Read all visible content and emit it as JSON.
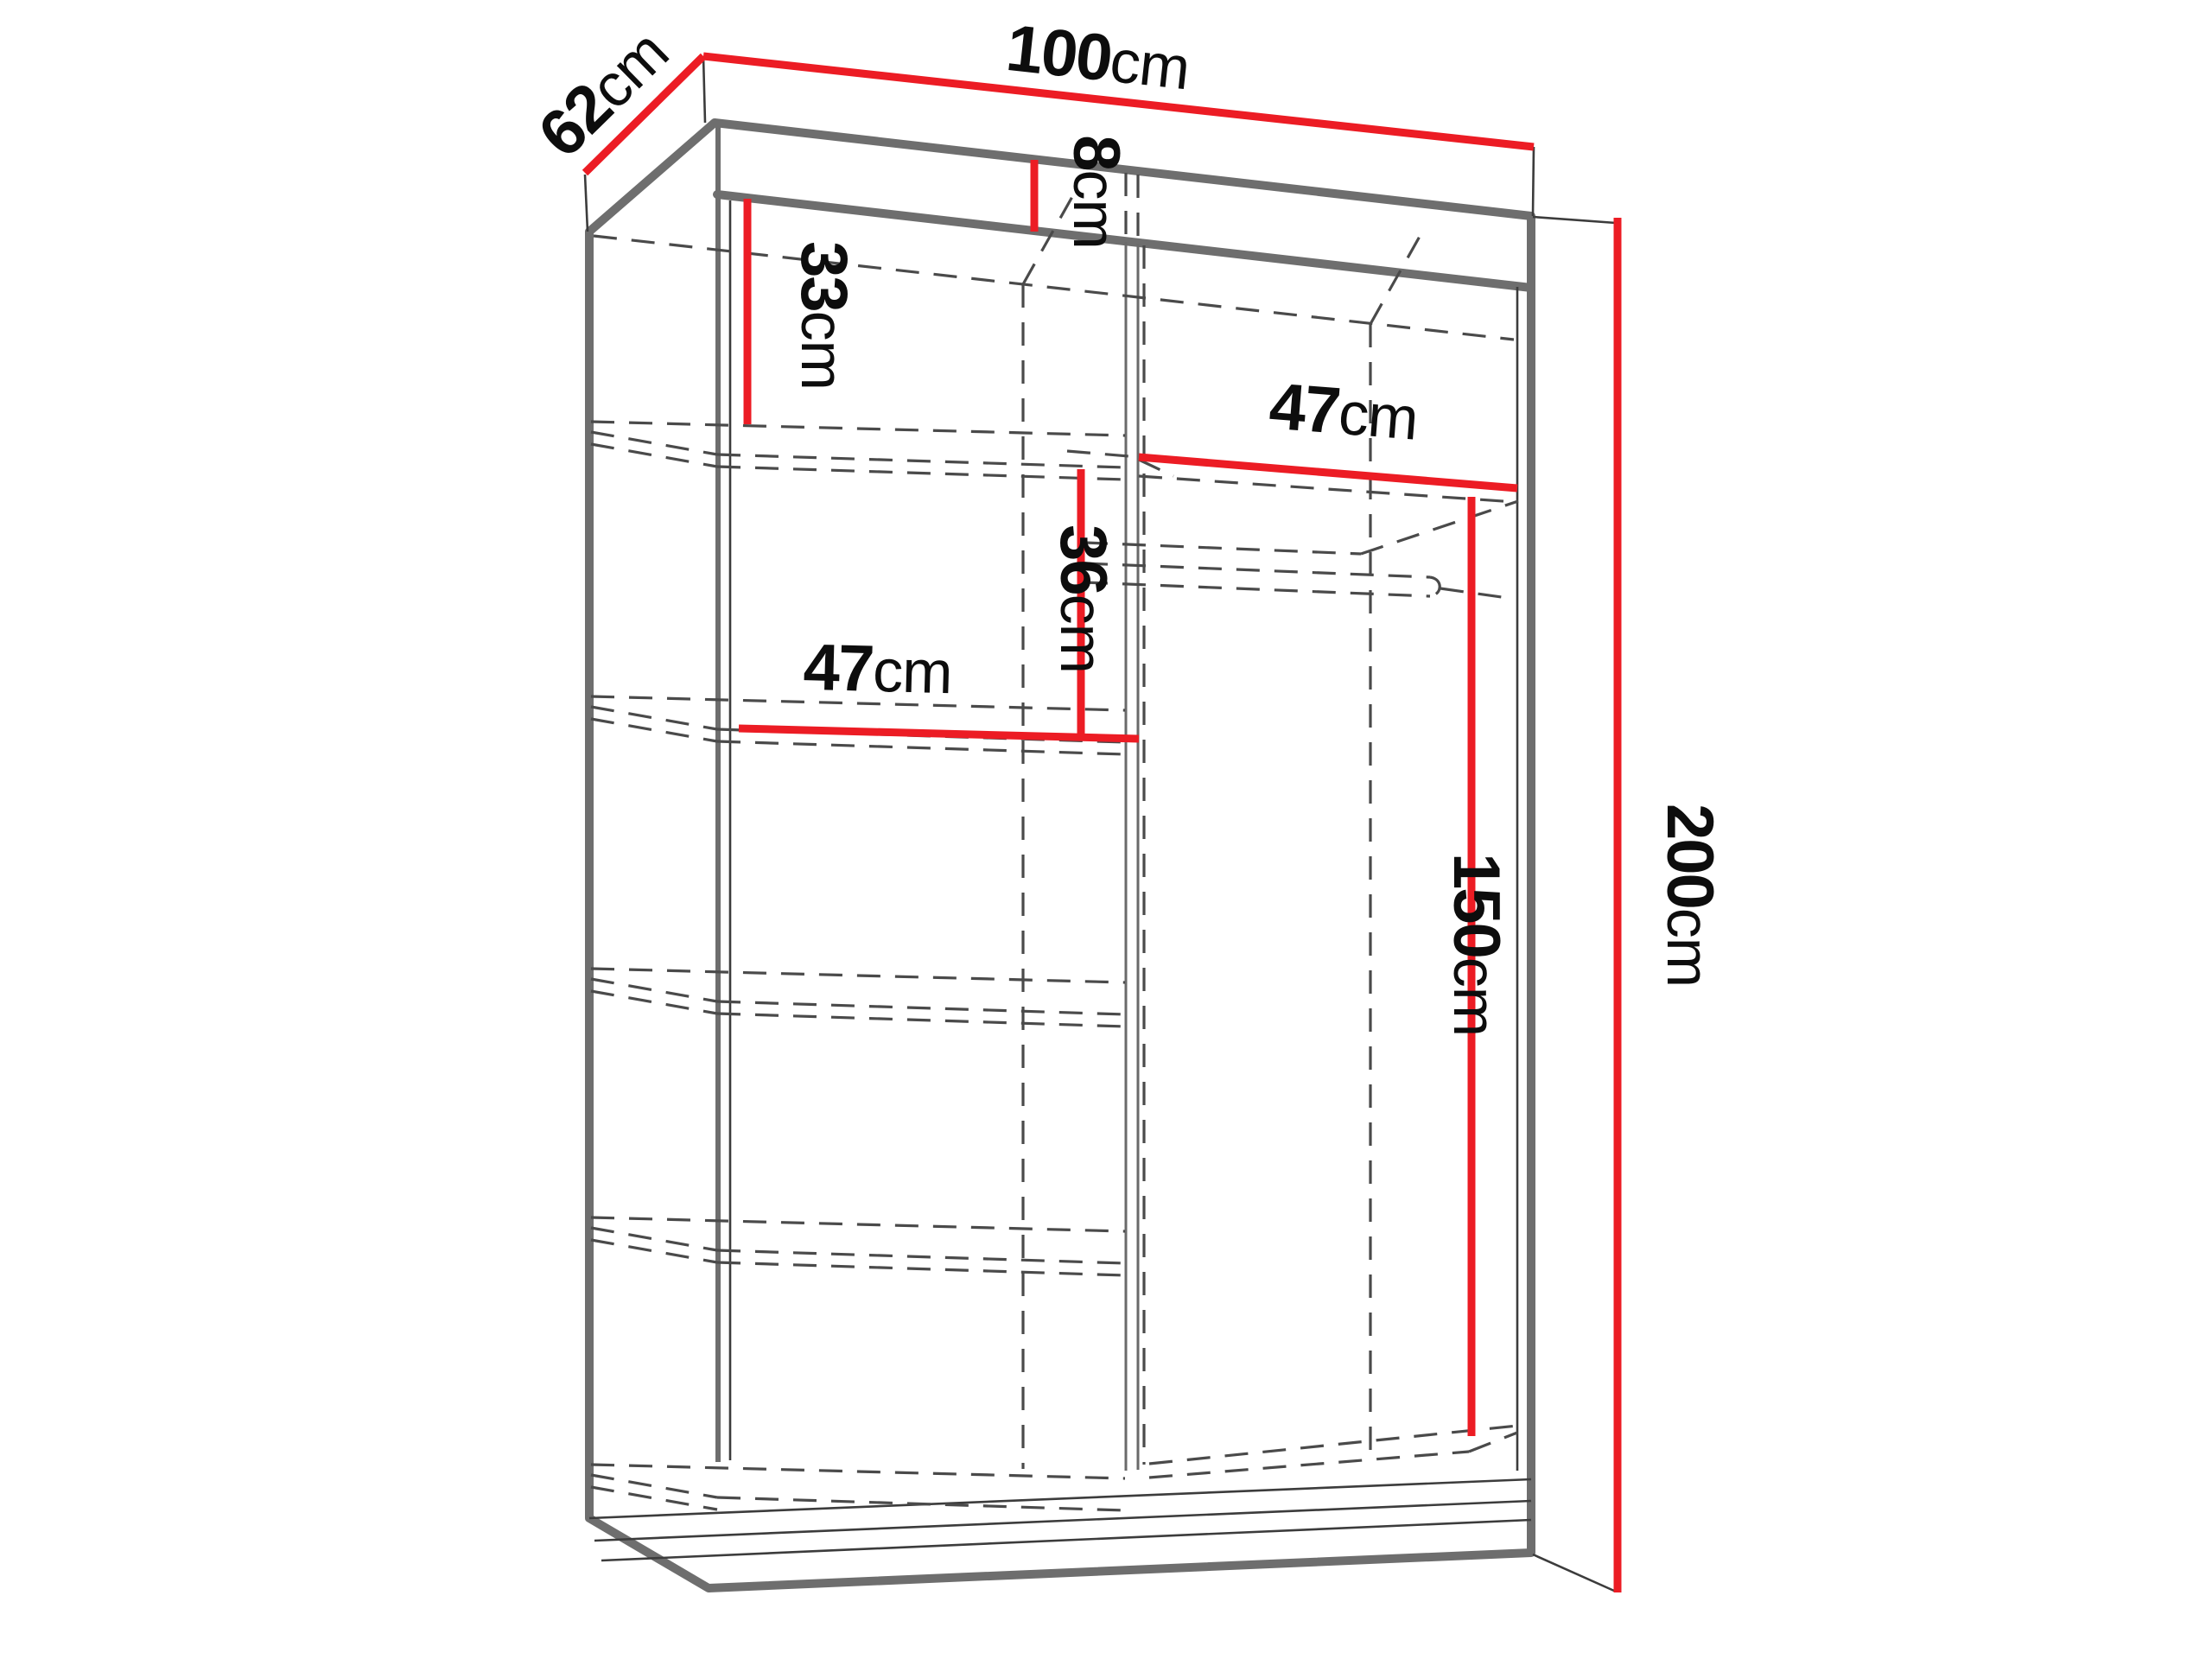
{
  "diagram": {
    "title": "wardrobe-interior-dimension-diagram",
    "type": "furniture dimension drawing",
    "colors": {
      "dimension_line": "#ec1c24",
      "outline": "#6e6e6e",
      "hidden_lines": "#4a4a4a",
      "text": "#0d0d0d",
      "background": "#ffffff"
    },
    "dimensions": {
      "depth": {
        "num": "62",
        "unit": "cm",
        "value": 62,
        "measures": "wardrobe depth (top left edge)"
      },
      "width": {
        "num": "100",
        "unit": "cm",
        "value": 100,
        "measures": "wardrobe width (top edge)"
      },
      "top_track": {
        "num": "8",
        "unit": "cm",
        "value": 8,
        "measures": "top cornice / track height"
      },
      "upper_section": {
        "num": "33",
        "unit": "cm",
        "value": 33,
        "measures": "height from ceiling to first left shelf"
      },
      "right_shelf": {
        "num": "47",
        "unit": "cm",
        "value": 47,
        "measures": "right compartment shelf width"
      },
      "mid_section": {
        "num": "36",
        "unit": "cm",
        "value": 36,
        "measures": "height between shelf levels"
      },
      "left_shelf": {
        "num": "47",
        "unit": "cm",
        "value": 47,
        "measures": "left compartment shelf width"
      },
      "hanging": {
        "num": "150",
        "unit": "cm",
        "value": 150,
        "measures": "hanging space height (rod area)"
      },
      "height": {
        "num": "200",
        "unit": "cm",
        "value": 200,
        "measures": "total wardrobe height (right edge)"
      }
    },
    "structure": {
      "left_column_shelves": 4,
      "right_column": "shelf + hanging rod",
      "doors": "2 sliding doors (dashed edges)"
    }
  }
}
